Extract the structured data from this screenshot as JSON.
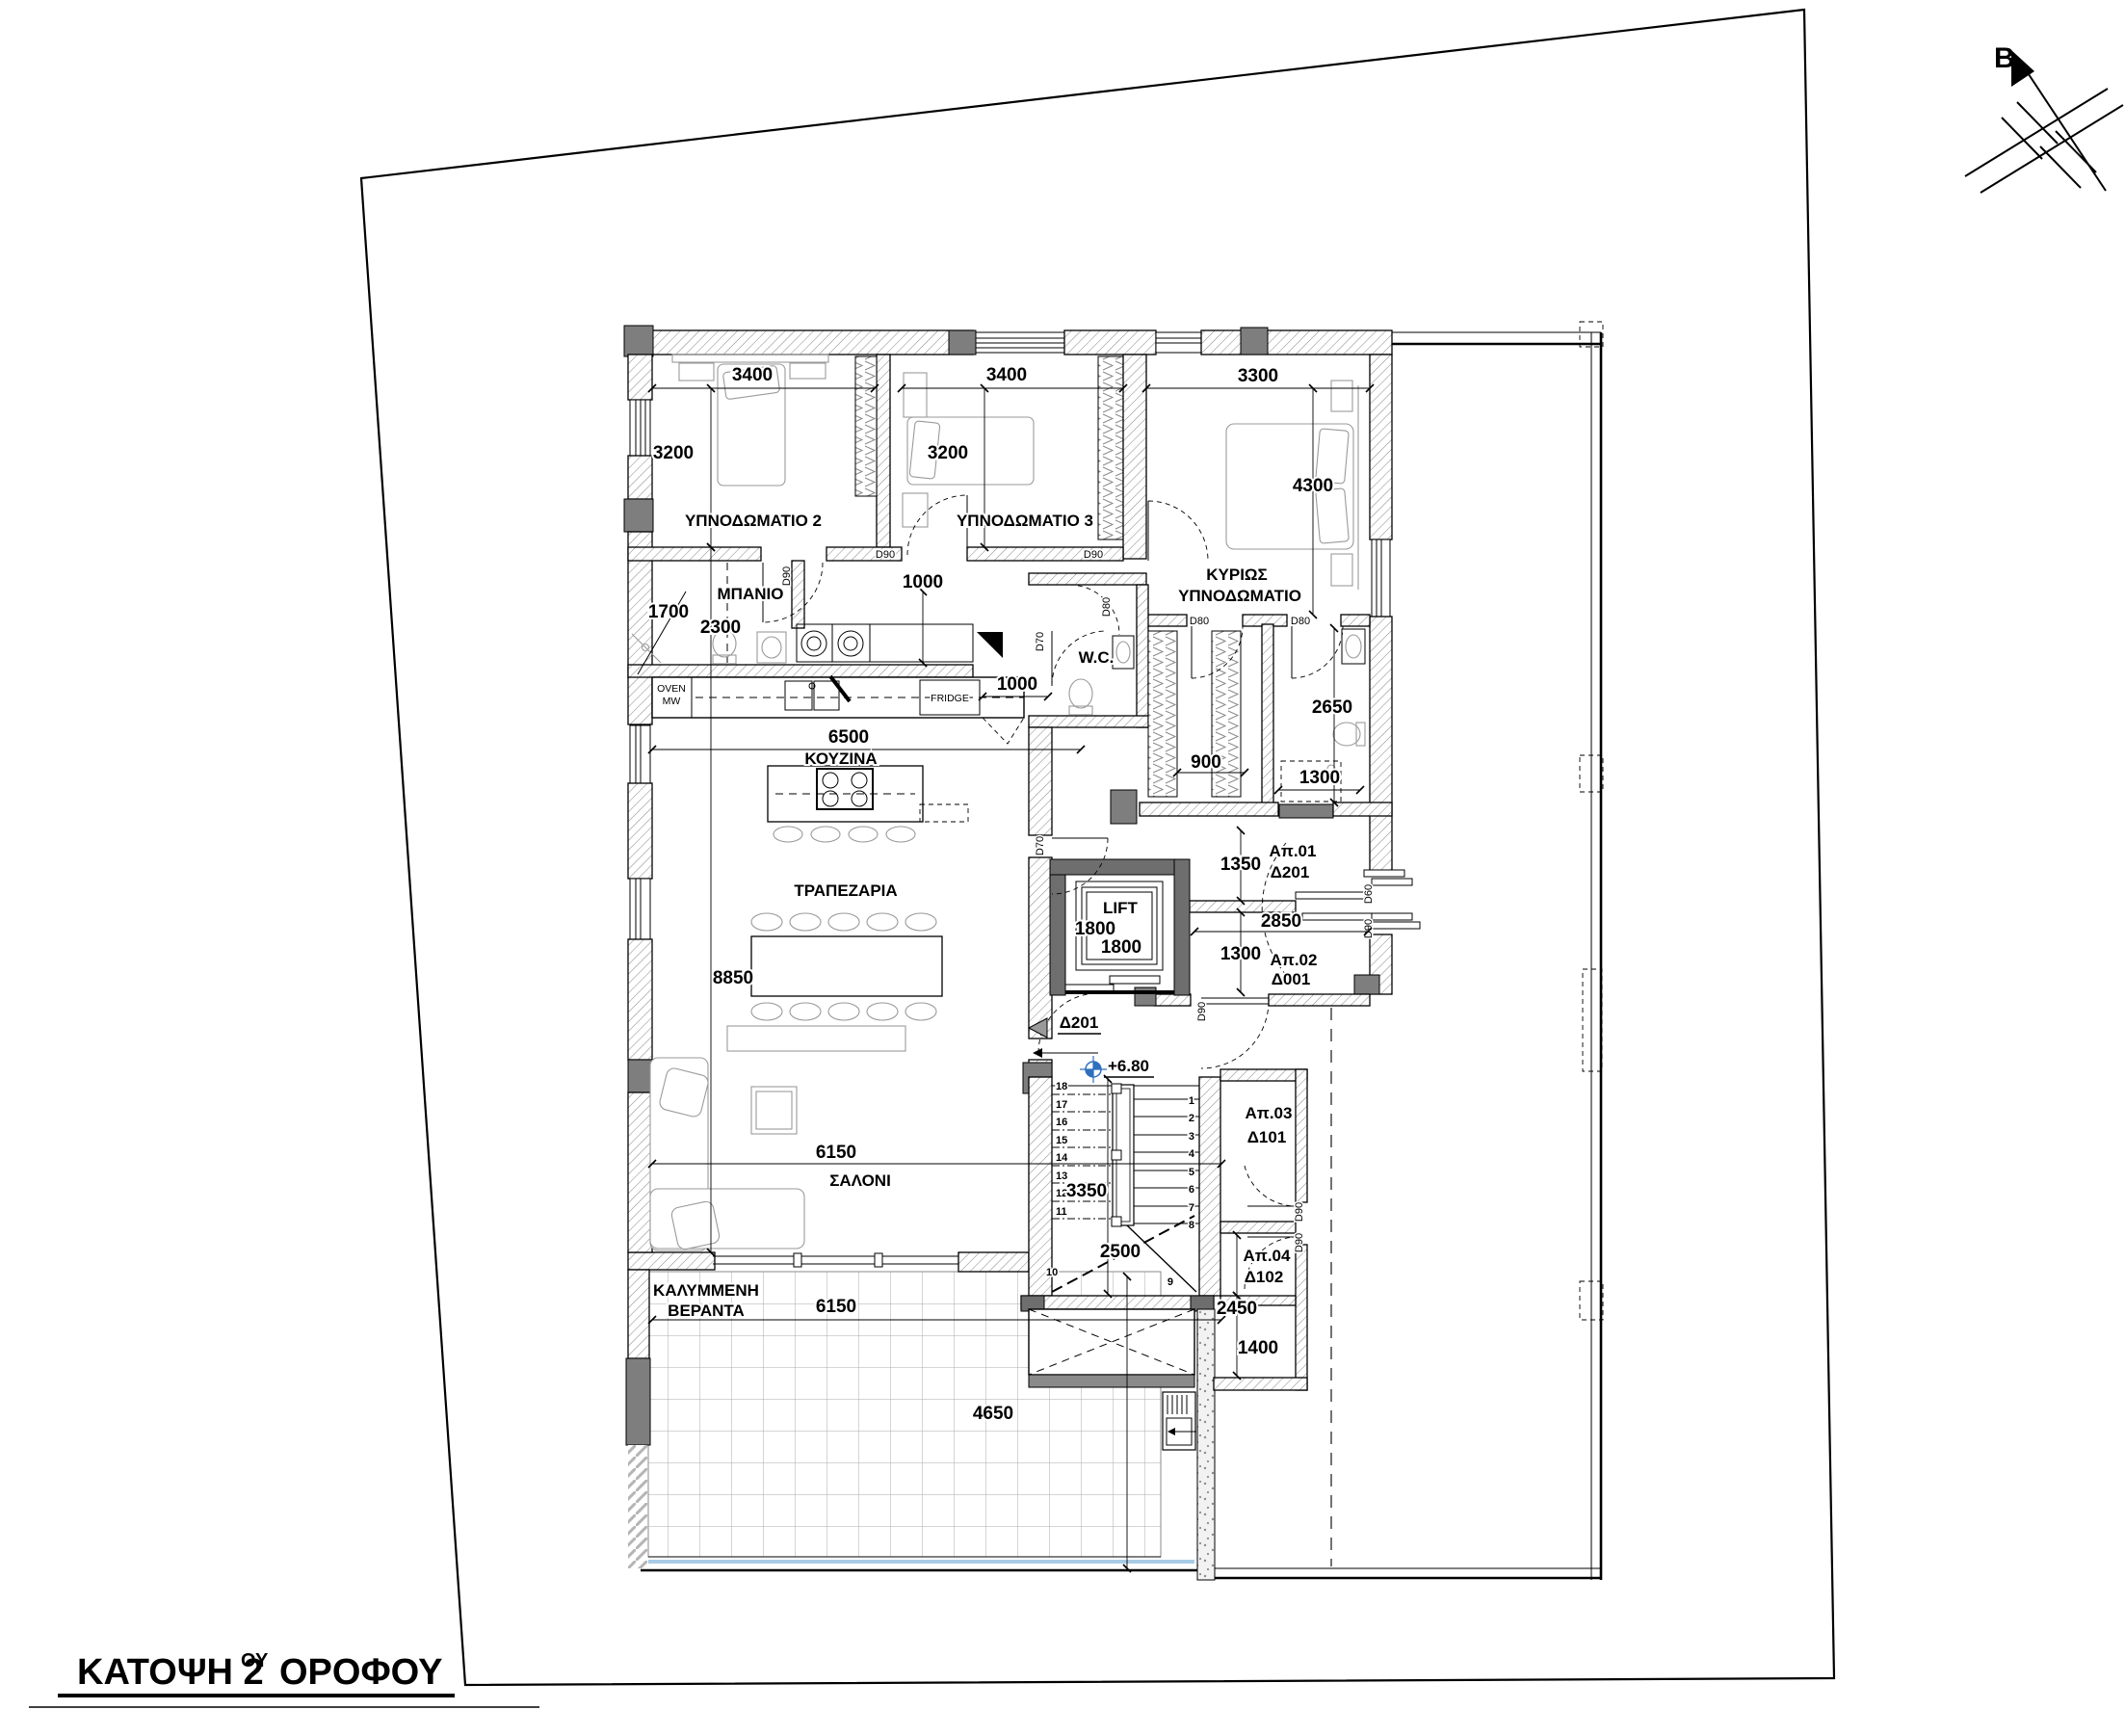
{
  "title": {
    "prefix": "ΚΑΤΟΨΗ 2",
    "sup": "ΟΥ",
    "suffix": "ΟΡΟΦΟΥ"
  },
  "north": {
    "label": "B"
  },
  "rooms": {
    "bedroom2": "ΥΠΝΟΔΩΜΑΤΙΟ 2",
    "bedroom3": "ΥΠΝΟΔΩΜΑΤΙΟ 3",
    "master1": "ΚΥΡΙΩΣ",
    "master2": "ΥΠΝΟΔΩΜΑΤΙΟ",
    "bathroom": "ΜΠΑΝΙΟ",
    "wc": "W.C.",
    "kitchen": "ΚΟΥΖΙΝΑ",
    "dining": "ΤΡΑΠΕΖΑΡΙΑ",
    "living": "ΣΑΛΟΝΙ",
    "veranda1": "ΚΑΛΥΜΜΕΝΗ",
    "veranda2": "ΒΕΡΑΝΤΑ",
    "lift": "LIFT"
  },
  "apartments": [
    {
      "name": "Απ.01",
      "code": "Δ201"
    },
    {
      "name": "Απ.02",
      "code": "Δ001"
    },
    {
      "name": "Απ.03",
      "code": "Δ101"
    },
    {
      "name": "Απ.04",
      "code": "Δ102"
    }
  ],
  "entrance": {
    "marker": "Δ201",
    "level": "+6.80"
  },
  "appliances": {
    "oven1": "OVEN",
    "oven2": "MW",
    "fridge": "FRIDGE"
  },
  "doors": {
    "d90": "D90",
    "d80": "D80",
    "d70": "D70",
    "d60": "D60"
  },
  "dims": {
    "bed2_w": "3400",
    "bed2_h": "3200",
    "bed3_w": "3400",
    "bed3_h": "3200",
    "master_w": "3300",
    "master_h": "4300",
    "bath_w": "1700",
    "bath_l": "2300",
    "hall": "1000",
    "kitchen_len": "6500",
    "counter": "1000",
    "closet": "900",
    "ensuite_len": "2650",
    "ensuite_w": "1300",
    "lobby_a": "1350",
    "lobby_len": "2850",
    "lobby_b": "1300",
    "lift_w": "1800",
    "lift_d": "1800",
    "living_len": "8850",
    "salon_w": "6150",
    "stair_len": "3350",
    "stair_w": "2500",
    "veranda_w": "6150",
    "veranda_d": "4650",
    "storage_a": "2450",
    "storage_b": "1400"
  },
  "stairs": {
    "left": [
      "18",
      "17",
      "16",
      "15",
      "14",
      "13",
      "12",
      "11"
    ],
    "left_low": "10",
    "right": [
      "1",
      "2",
      "3",
      "4",
      "5",
      "6",
      "7",
      "8"
    ],
    "right_low": "9"
  }
}
